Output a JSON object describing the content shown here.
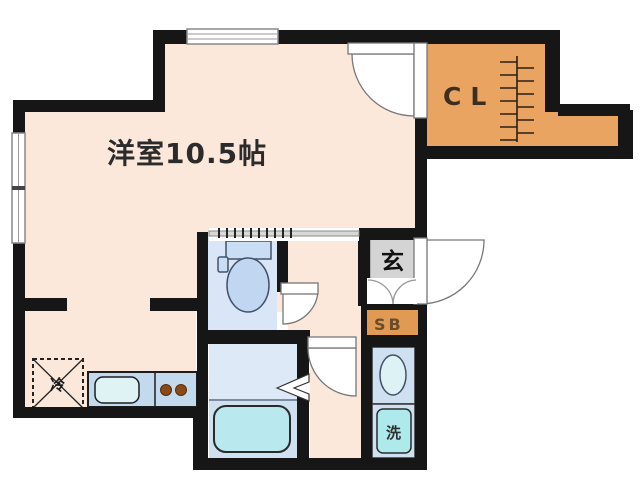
{
  "plan": {
    "type": "japanese-apartment-floor-plan",
    "labels": {
      "main_room": "洋室10.5帖",
      "closet": "CL",
      "entrance": "玄",
      "shoe_box": "SB",
      "washing_machine": "洗",
      "refrigerator": "冷"
    },
    "colors": {
      "wall": "#161616",
      "room_floor": "#fbe8da",
      "closet_fill": "#eaa462",
      "wet_room_fill": "#d9e6f7",
      "bathtub_fill": "#b9e9ee",
      "kitchen_counter": "#c3daee",
      "sink_fill": "#dff2f4",
      "entrance_floor": "#d4d4d4",
      "burner": "#8a4a17",
      "door_line": "#777777"
    }
  }
}
